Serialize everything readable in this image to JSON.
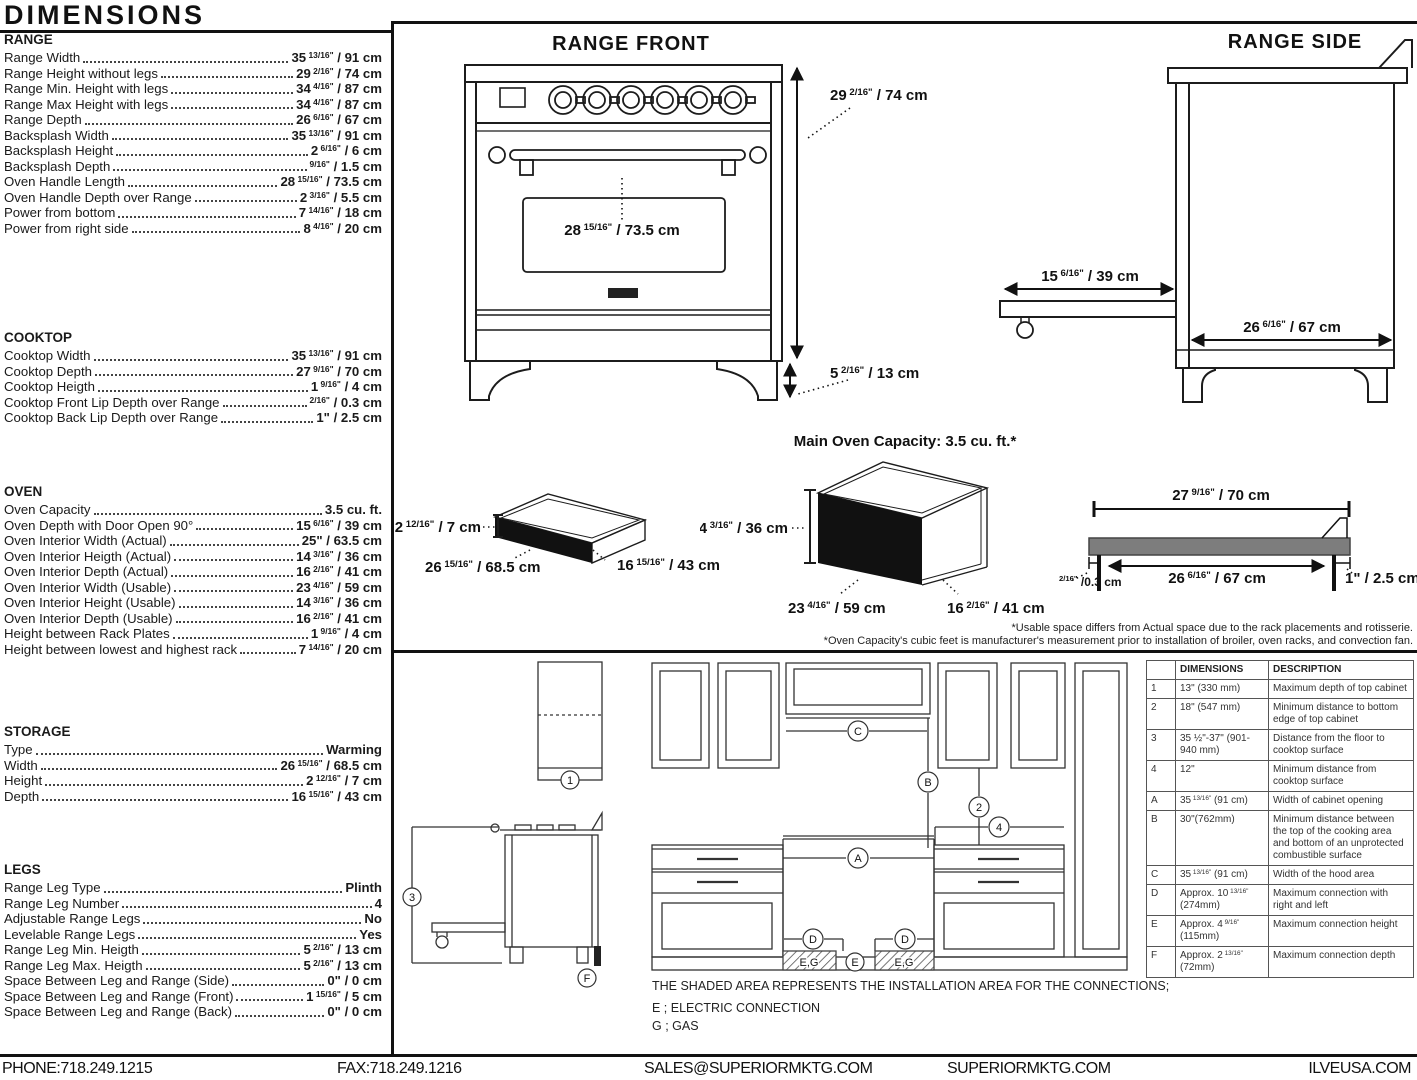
{
  "page": {
    "title": "DIMENSIONS"
  },
  "specs": {
    "sections": [
      {
        "title": "RANGE",
        "rows": [
          {
            "label": "Range Width",
            "value": {
              "pre": "35",
              "sup": "13/16\"",
              "post": "/ 91 cm"
            }
          },
          {
            "label": "Range Height without legs",
            "value": {
              "pre": "29",
              "sup": "2/16\"",
              "post": "/ 74 cm"
            }
          },
          {
            "label": "Range Min. Height with legs",
            "value": {
              "pre": "34",
              "sup": "4/16\"",
              "post": "/ 87 cm"
            }
          },
          {
            "label": "Range Max Height with legs",
            "value": {
              "pre": "34",
              "sup": "4/16\"",
              "post": "/ 87 cm"
            }
          },
          {
            "label": "Range Depth",
            "value": {
              "pre": "26",
              "sup": "6/16\"",
              "post": "/ 67 cm"
            }
          },
          {
            "label": "Backsplash Width",
            "value": {
              "pre": "35",
              "sup": "13/16\"",
              "post": "/ 91 cm"
            }
          },
          {
            "label": "Backsplash Height",
            "value": {
              "pre": "2",
              "sup": "6/16\"",
              "post": "/ 6 cm"
            }
          },
          {
            "label": "Backsplash Depth",
            "value": {
              "pre": "",
              "sup": "9/16\"",
              "post": "/ 1.5 cm"
            }
          },
          {
            "label": "Oven Handle Length",
            "value": {
              "pre": "28",
              "sup": "15/16\"",
              "post": "/ 73.5 cm"
            }
          },
          {
            "label": "Oven Handle Depth over Range",
            "value": {
              "pre": "2",
              "sup": "3/16\"",
              "post": "/ 5.5 cm"
            }
          },
          {
            "label": "Power from bottom",
            "value": {
              "pre": "7",
              "sup": "14/16\"",
              "post": "/ 18 cm"
            }
          },
          {
            "label": "Power from right side",
            "value": {
              "pre": "8",
              "sup": "4/16\"",
              "post": "/ 20 cm"
            }
          }
        ]
      },
      {
        "title": "COOKTOP",
        "rows": [
          {
            "label": "Cooktop Width",
            "value": {
              "pre": "35",
              "sup": "13/16\"",
              "post": "/ 91 cm"
            }
          },
          {
            "label": "Cooktop Depth",
            "value": {
              "pre": "27",
              "sup": "9/16\"",
              "post": "/ 70 cm"
            }
          },
          {
            "label": "Cooktop Heigth",
            "value": {
              "pre": "1",
              "sup": "9/16\"",
              "post": "/ 4 cm"
            }
          },
          {
            "label": "Cooktop Front Lip Depth over Range",
            "value": {
              "pre": "",
              "sup": "2/16\"",
              "post": "/ 0.3 cm"
            }
          },
          {
            "label": "Cooktop Back Lip Depth over Range",
            "value": {
              "pre": "1\"",
              "sup": "",
              "post": "/ 2.5 cm"
            }
          }
        ]
      },
      {
        "title": "OVEN",
        "rows": [
          {
            "label": "Oven Capacity",
            "value": {
              "pre": "3.5 cu. ft.",
              "sup": "",
              "post": ""
            }
          },
          {
            "label": "Oven Depth with Door Open 90°",
            "value": {
              "pre": "15",
              "sup": "6/16\"",
              "post": "/ 39 cm"
            }
          },
          {
            "label": "Oven Interior Width (Actual)",
            "value": {
              "pre": "25\"",
              "sup": "",
              "post": "/ 63.5 cm"
            }
          },
          {
            "label": "Oven Interior Heigth (Actual)",
            "value": {
              "pre": "14",
              "sup": "3/16\"",
              "post": "/ 36 cm"
            }
          },
          {
            "label": "Oven Interior Depth (Actual)",
            "value": {
              "pre": "16",
              "sup": "2/16\"",
              "post": "/ 41 cm"
            }
          },
          {
            "label": "Oven Interior Width (Usable)",
            "value": {
              "pre": "23",
              "sup": "4/16\"",
              "post": "/ 59 cm"
            }
          },
          {
            "label": "Oven Interior Height (Usable)",
            "value": {
              "pre": "14",
              "sup": "3/16\"",
              "post": "/ 36 cm"
            }
          },
          {
            "label": "Oven Interior Depth (Usable)",
            "value": {
              "pre": "16",
              "sup": "2/16\"",
              "post": "/ 41 cm"
            }
          },
          {
            "label": "Height between Rack Plates",
            "value": {
              "pre": "1",
              "sup": "9/16\"",
              "post": "/ 4 cm"
            }
          },
          {
            "label": "Height between lowest and highest rack",
            "value": {
              "pre": "7",
              "sup": "14/16\"",
              "post": "/ 20 cm"
            }
          }
        ]
      },
      {
        "title": "STORAGE",
        "rows": [
          {
            "label": "Type",
            "value": {
              "pre": "Warming",
              "sup": "",
              "post": ""
            }
          },
          {
            "label": "Width",
            "value": {
              "pre": "26",
              "sup": "15/16\"",
              "post": "/ 68.5 cm"
            }
          },
          {
            "label": "Height",
            "value": {
              "pre": "2",
              "sup": "12/16\"",
              "post": "/ 7 cm"
            }
          },
          {
            "label": "Depth",
            "value": {
              "pre": "16",
              "sup": "15/16\"",
              "post": "/ 43 cm"
            }
          }
        ]
      },
      {
        "title": "LEGS",
        "rows": [
          {
            "label": "Range Leg Type",
            "value": {
              "pre": "Plinth",
              "sup": "",
              "post": ""
            }
          },
          {
            "label": "Range Leg Number",
            "value": {
              "pre": "4",
              "sup": "",
              "post": ""
            }
          },
          {
            "label": "Adjustable Range Legs",
            "value": {
              "pre": "No",
              "sup": "",
              "post": ""
            }
          },
          {
            "label": "Levelable Range Legs",
            "value": {
              "pre": "Yes",
              "sup": "",
              "post": ""
            }
          },
          {
            "label": "Range Leg Min. Heigth",
            "value": {
              "pre": "5",
              "sup": "2/16\"",
              "post": "/ 13 cm"
            }
          },
          {
            "label": "Range Leg Max. Heigth",
            "value": {
              "pre": "5",
              "sup": "2/16\"",
              "post": "/ 13 cm"
            }
          },
          {
            "label": "Space Between Leg and Range (Side)",
            "value": {
              "pre": "0\"",
              "sup": "",
              "post": "/ 0 cm"
            }
          },
          {
            "label": "Space Between Leg and Range (Front)",
            "value": {
              "pre": "1",
              "sup": "15/16\"",
              "post": "/ 5 cm"
            }
          },
          {
            "label": "Space Between Leg and Range (Back)",
            "value": {
              "pre": "0\"",
              "sup": "",
              "post": "/ 0 cm"
            }
          }
        ]
      }
    ]
  },
  "diagrams": {
    "range_front": {
      "title": "RANGE FRONT",
      "dims": {
        "height": {
          "pre": "29",
          "sup": "2/16\"",
          "post": "/ 74 cm"
        },
        "legs": {
          "pre": "5",
          "sup": "2/16\"",
          "post": "/ 13 cm"
        },
        "handle": {
          "pre": "28",
          "sup": "15/16\"",
          "post": "/ 73.5 cm"
        }
      }
    },
    "range_side": {
      "title": "RANGE SIDE",
      "dims": {
        "drawer": {
          "pre": "15",
          "sup": "6/16\"",
          "post": "/ 39 cm"
        },
        "depth": {
          "pre": "26",
          "sup": "6/16\"",
          "post": "/ 67 cm"
        }
      }
    },
    "warming_drawer": {
      "dims": {
        "height": {
          "pre": "2",
          "sup": "12/16\"",
          "post": "/ 7 cm"
        },
        "width": {
          "pre": "26",
          "sup": "15/16\"",
          "post": "/ 68.5 cm"
        },
        "depth": {
          "pre": "16",
          "sup": "15/16\"",
          "post": "/ 43 cm"
        }
      }
    },
    "main_oven": {
      "title": "Main Oven Capacity: 3.5 cu. ft.*",
      "dims": {
        "height": {
          "pre": "14",
          "sup": "3/16\"",
          "post": "/ 36 cm"
        },
        "width": {
          "pre": "23",
          "sup": "4/16\"",
          "post": "/ 59 cm"
        },
        "depth": {
          "pre": "16",
          "sup": "2/16\"",
          "post": "/ 41 cm"
        }
      }
    },
    "cooktop_profile": {
      "dims": {
        "overall": {
          "pre": "27",
          "sup": "9/16\"",
          "post": "/ 70 cm"
        },
        "inner": {
          "pre": "26",
          "sup": "6/16\"",
          "post": "/ 67 cm"
        },
        "back_lip": {
          "pre": "",
          "sup": "2/16\"",
          "post": "/0.3 cm"
        },
        "front_lip": {
          "pre": "1\"",
          "sup": "",
          "post": "/ 2.5 cm"
        }
      }
    },
    "notes": [
      "*Usable space differs from Actual space due to the rack placements and rotisserie.",
      "*Oven Capacity's cubic feet is manufacturer's measurement prior to installation of broiler, oven racks, and convection fan."
    ]
  },
  "installation": {
    "side_view": {
      "callouts": {
        "top_cabinet": "1",
        "floor_height": "3",
        "connection_depth": "F"
      }
    },
    "elevation": {
      "callouts": {
        "hood_width": "C",
        "combustible_clearance": "B",
        "cabinet_clearance": "2",
        "min_distance": "4",
        "opening_width": "A",
        "connection_left": "D",
        "connection_right": "D",
        "connection_height": "E"
      },
      "hatch_labels": [
        "E,G",
        "E,G"
      ]
    },
    "caption": "THE SHADED AREA REPRESENTS THE INSTALLATION AREA FOR THE CONNECTIONS;",
    "legend": [
      "E ; ELECTRIC CONNECTION",
      "G ; GAS"
    ]
  },
  "reference_table": {
    "headers": [
      "",
      "DIMENSIONS",
      "DESCRIPTION"
    ],
    "rows": [
      {
        "id": "1",
        "dimension": "13\" (330 mm)",
        "description": "Maximum depth of top cabinet"
      },
      {
        "id": "2",
        "dimension": "18\" (547 mm)",
        "description": "Minimum distance to bottom edge of top cabinet"
      },
      {
        "id": "3",
        "dimension": "35 ½\"-37\" (901-940 mm)",
        "description": "Distance from the floor to cooktop surface"
      },
      {
        "id": "4",
        "dimension": "12\"",
        "description": "Minimum distance from cooktop surface"
      },
      {
        "id": "A",
        "dimension": {
          "pre": "35",
          "sup": "13/16\"",
          "post": "(91 cm)"
        },
        "description": "Width of cabinet opening"
      },
      {
        "id": "B",
        "dimension": "30\"(762mm)",
        "description": "Minimum distance between the top of the cooking area and bottom of an unprotected combustible surface"
      },
      {
        "id": "C",
        "dimension": {
          "pre": "35",
          "sup": "13/16\"",
          "post": "(91 cm)"
        },
        "description": "Width of the hood area"
      },
      {
        "id": "D",
        "dimension": {
          "pre": "Approx. 10",
          "sup": "13/16\"",
          "post": "(274mm)"
        },
        "description": "Maximum connection with right and left"
      },
      {
        "id": "E",
        "dimension": {
          "pre": "Approx. 4",
          "sup": "9/16\"",
          "post": "(115mm)"
        },
        "description": "Maximum connection height"
      },
      {
        "id": "F",
        "dimension": {
          "pre": "Approx. 2",
          "sup": "13/16\"",
          "post": "(72mm)"
        },
        "description": "Maximum connection depth"
      }
    ]
  },
  "footer": {
    "items": [
      "PHONE:718.249.1215",
      "FAX:718.249.1216",
      "SALES@SUPERIORMKTG.COM",
      "SUPERIORMKTG.COM",
      "ILVEUSA.COM"
    ]
  }
}
